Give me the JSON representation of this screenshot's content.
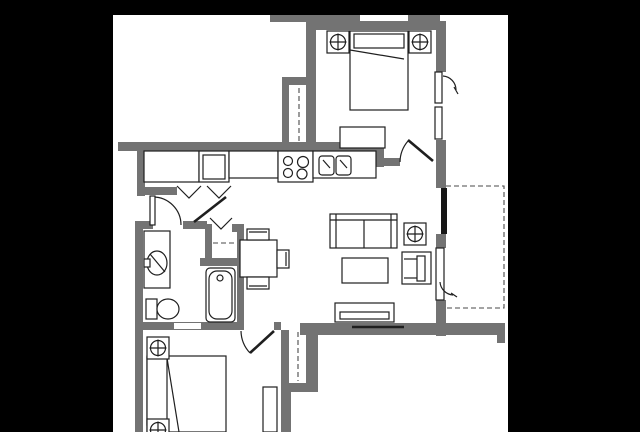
{
  "meta": {
    "kind": "architectural floor plan drawing",
    "description": "Black-and-white one-bedroom-plus-den apartment floor plan, cropped by black bars on left, right and top edges; plan is cut off at the bottom edge",
    "visible_text_labels": []
  },
  "colors": {
    "background": "#000000",
    "paper": "#ffffff",
    "wall": "#737373",
    "line": "#1f1f1f",
    "dashed": "#4a4a4a",
    "window_dark": "#161616"
  },
  "rooms": [
    {
      "name": "bedroom-upper",
      "location": "top right",
      "features": [
        "double bed with pillow",
        "dresser bench",
        "2 ceiling fixtures",
        "casement window right wall",
        "swing door bottom right"
      ]
    },
    {
      "name": "wardrobe-closet-upper",
      "location": "left of upper bedroom",
      "features": [
        "dashed hanging rod"
      ]
    },
    {
      "name": "kitchen",
      "location": "upper middle, galley",
      "features": [
        "counter run",
        "refrigerator",
        "4-burner range",
        "double sink",
        "dashed upper cabinets"
      ]
    },
    {
      "name": "laundry-pantry-closet",
      "location": "kitchen left end",
      "features": [
        "two bifold doors"
      ]
    },
    {
      "name": "entry-hall",
      "location": "right of kitchen",
      "features": [
        "door swing into upper bedroom"
      ]
    },
    {
      "name": "living-room",
      "location": "center right",
      "features": [
        "sofa",
        "coffee table",
        "armchair",
        "tv console",
        "ceiling fixture",
        "windows on right wall"
      ]
    },
    {
      "name": "dining-area",
      "location": "center",
      "features": [
        "square table",
        "3 chairs"
      ]
    },
    {
      "name": "bathroom",
      "location": "center left",
      "features": [
        "vanity sink",
        "toilet",
        "bathtub",
        "swing door"
      ]
    },
    {
      "name": "linen-closet",
      "location": "between bathroom and dining",
      "features": [
        "bifold door",
        "dashed shelf"
      ]
    },
    {
      "name": "bedroom-lower",
      "location": "bottom left, cut off",
      "features": [
        "double bed",
        "2 ceiling fixtures",
        "swing door",
        "closet with dashed rod"
      ]
    },
    {
      "name": "balcony",
      "location": "right, dashed outline",
      "features": [
        "dashed perimeter"
      ]
    }
  ],
  "symbols": [
    {
      "name": "ceiling-fixture",
      "glyph": "square with crossed circle",
      "count": 5
    },
    {
      "name": "door-swing-arc",
      "count": 4
    },
    {
      "name": "bifold-door",
      "glyph": "V shape",
      "count": 3
    },
    {
      "name": "casement-window-arc",
      "count": 2
    }
  ]
}
